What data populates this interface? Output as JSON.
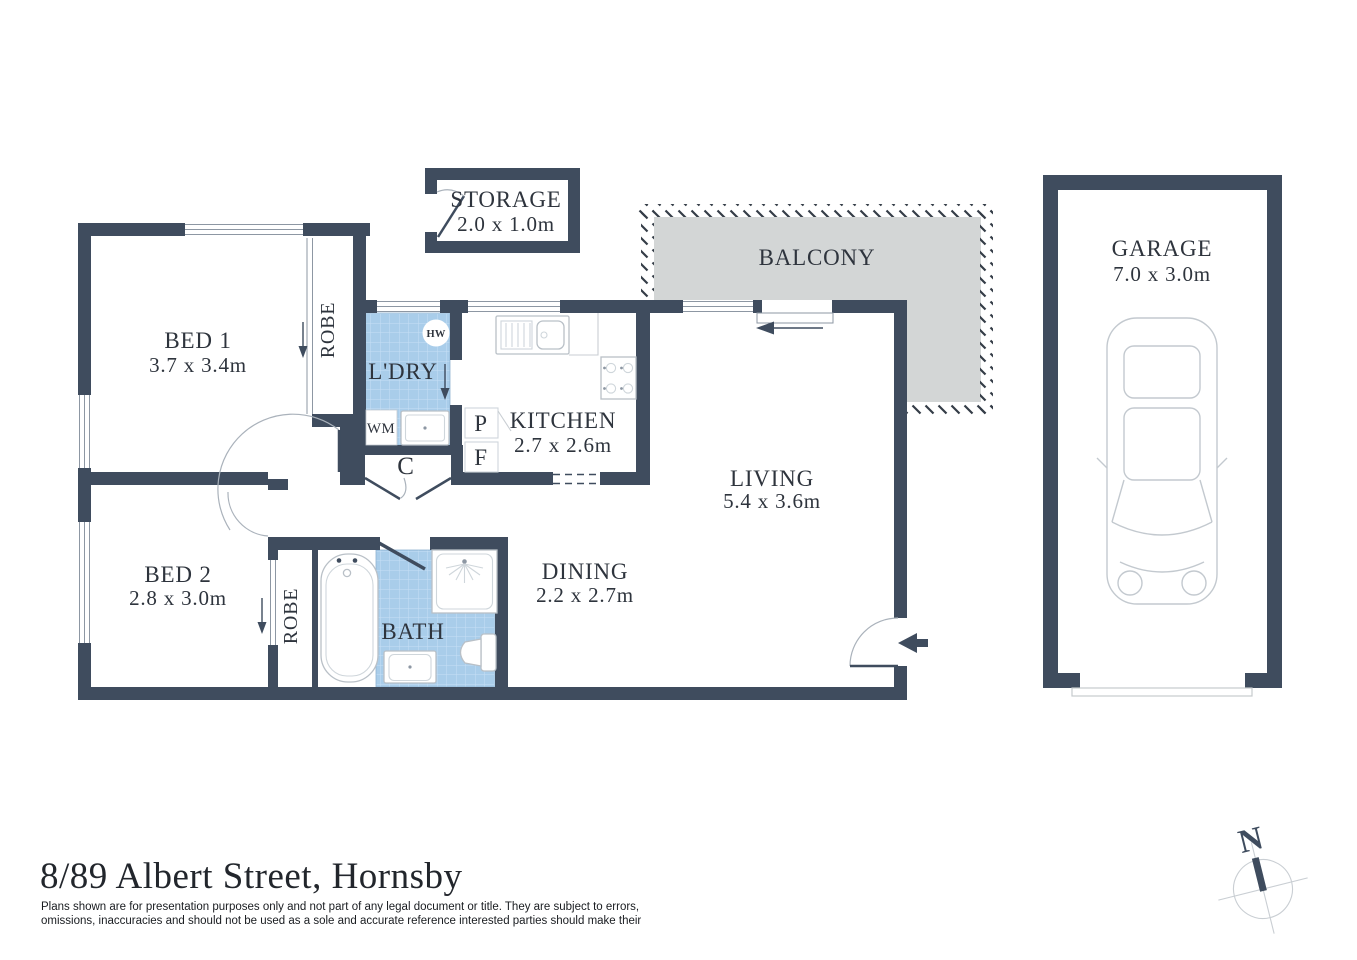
{
  "page": {
    "title_text": "8/89 Albert Street, Hornsby",
    "disclaimer_line1": "Plans shown are for presentation purposes only and not part of any legal document or title. They are subject to errors,",
    "disclaimer_line2": "omissions, inaccuracies and should not be used as a sole and accurate reference interested parties should make their"
  },
  "rooms": {
    "bed1": {
      "name": "BED 1",
      "dims": "3.7 x 3.4m"
    },
    "bed2": {
      "name": "BED 2",
      "dims": "2.8 x 3.0m"
    },
    "living": {
      "name": "LIVING",
      "dims": "5.4 x 3.6m"
    },
    "dining": {
      "name": "DINING",
      "dims": "2.2 x 2.7m"
    },
    "kitchen": {
      "name": "KITCHEN",
      "dims": "2.7 x 2.6m"
    },
    "laundry": {
      "name": "L'DRY"
    },
    "bath": {
      "name": "BATH"
    },
    "balcony": {
      "name": "BALCONY"
    },
    "storage": {
      "name": "STORAGE",
      "dims": "2.0 x 1.0m"
    },
    "garage": {
      "name": "GARAGE",
      "dims": "7.0 x 3.0m"
    },
    "robe1": {
      "name": "ROBE"
    },
    "robe2": {
      "name": "ROBE"
    }
  },
  "fixtures": {
    "hot_water": "HW",
    "washing_machine": "WM",
    "pantry": "P",
    "fridge": "F",
    "cupboard": "C"
  },
  "compass": {
    "north": "N"
  },
  "colors": {
    "wall": "#3f4c5e",
    "tile_blue": "#a9cdea",
    "balcony_grey": "#d3d6d6",
    "label_text": "#2e343d"
  }
}
